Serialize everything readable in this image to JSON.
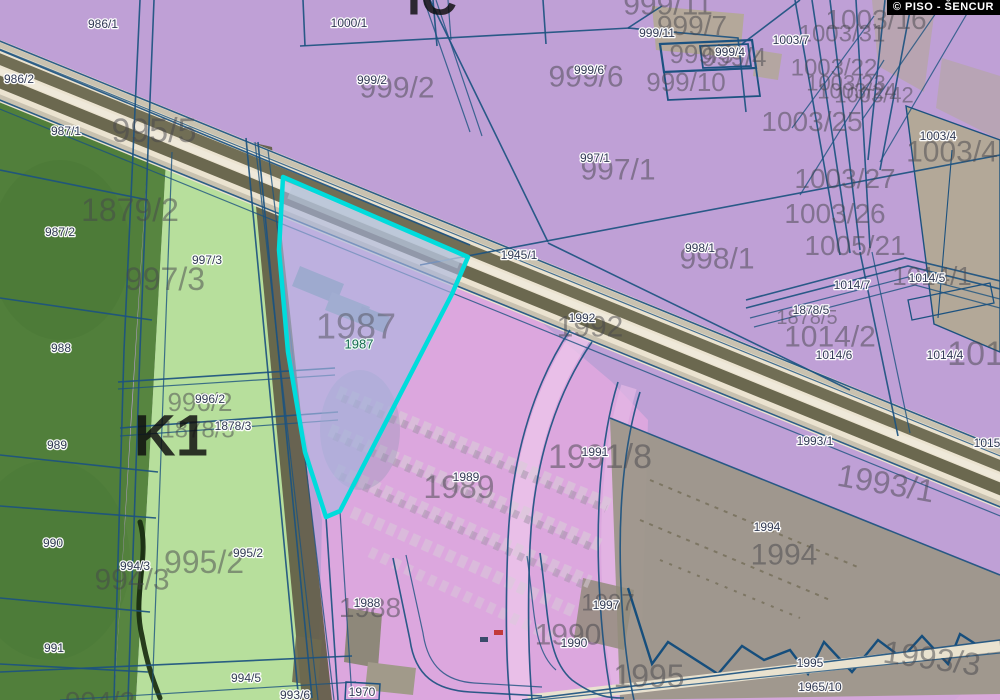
{
  "meta": {
    "copyright": "© PISO - ŠENCUR"
  },
  "colors": {
    "selected_outline": "#00dcdc",
    "selected_fill": "#a9b6e0",
    "zone_industrial_purple": "#bfa0d6",
    "zone_pink": "#e3a9e0",
    "field_dark_green": "#517f3b",
    "field_light_green": "#b7df9c",
    "boundary_line": "#1c5280",
    "road_fill": "#ebe3d0",
    "road_stripe": "#6f6c54",
    "building_gray": "#9d978a"
  },
  "selected_parcel": {
    "id": "1987"
  },
  "labels": {
    "small": [
      {
        "t": "986/1",
        "x": 103,
        "y": 24
      },
      {
        "t": "986/2",
        "x": 19,
        "y": 79
      },
      {
        "t": "987/1",
        "x": 66,
        "y": 131
      },
      {
        "t": "987/2",
        "x": 60,
        "y": 232
      },
      {
        "t": "997/3",
        "x": 207,
        "y": 260
      },
      {
        "t": "988",
        "x": 61,
        "y": 348
      },
      {
        "t": "989",
        "x": 57,
        "y": 445
      },
      {
        "t": "990",
        "x": 53,
        "y": 543
      },
      {
        "t": "991",
        "x": 54,
        "y": 648
      },
      {
        "t": "996/2",
        "x": 210,
        "y": 399
      },
      {
        "t": "1878/3",
        "x": 233,
        "y": 426
      },
      {
        "t": "994/3",
        "x": 135,
        "y": 566
      },
      {
        "t": "995/2",
        "x": 248,
        "y": 553
      },
      {
        "t": "994/5",
        "x": 246,
        "y": 678
      },
      {
        "t": "993/6",
        "x": 295,
        "y": 695
      },
      {
        "t": "1970",
        "x": 362,
        "y": 692
      },
      {
        "t": "1000/1",
        "x": 349,
        "y": 23
      },
      {
        "t": "999/2",
        "x": 372,
        "y": 80
      },
      {
        "t": "999/6",
        "x": 589,
        "y": 70
      },
      {
        "t": "999/11",
        "x": 657,
        "y": 33
      },
      {
        "t": "999/4",
        "x": 730,
        "y": 52
      },
      {
        "t": "1003/7",
        "x": 791,
        "y": 40
      },
      {
        "t": "1003/4",
        "x": 938,
        "y": 136
      },
      {
        "t": "1945/1",
        "x": 519,
        "y": 255
      },
      {
        "t": "997/1",
        "x": 595,
        "y": 158
      },
      {
        "t": "998/1",
        "x": 700,
        "y": 248
      },
      {
        "t": "1992",
        "x": 582,
        "y": 318
      },
      {
        "t": "1991",
        "x": 595,
        "y": 452
      },
      {
        "t": "1989",
        "x": 466,
        "y": 477
      },
      {
        "t": "1988",
        "x": 367,
        "y": 603
      },
      {
        "t": "1990",
        "x": 574,
        "y": 643
      },
      {
        "t": "1997",
        "x": 606,
        "y": 605
      },
      {
        "t": "1994",
        "x": 767,
        "y": 527
      },
      {
        "t": "1993/1",
        "x": 815,
        "y": 441
      },
      {
        "t": "1995",
        "x": 810,
        "y": 663
      },
      {
        "t": "1965/10",
        "x": 820,
        "y": 687
      },
      {
        "t": "1014/7",
        "x": 852,
        "y": 285
      },
      {
        "t": "1014/5",
        "x": 927,
        "y": 278
      },
      {
        "t": "1878/5",
        "x": 811,
        "y": 310
      },
      {
        "t": "1014/6",
        "x": 834,
        "y": 355
      },
      {
        "t": "1014/4",
        "x": 945,
        "y": 355
      },
      {
        "t": "1015/1",
        "x": 992,
        "y": 443
      }
    ],
    "large": [
      {
        "t": "1879/2",
        "x": 130,
        "y": 210,
        "s": 32
      },
      {
        "t": "995/5",
        "x": 154,
        "y": 130,
        "s": 34
      },
      {
        "t": "997/3",
        "x": 165,
        "y": 279,
        "s": 32
      },
      {
        "t": "996/2",
        "x": 200,
        "y": 402,
        "s": 26
      },
      {
        "t": "1878/3",
        "x": 198,
        "y": 429,
        "s": 24
      },
      {
        "t": "994/3",
        "x": 132,
        "y": 579,
        "s": 30
      },
      {
        "t": "995/2",
        "x": 204,
        "y": 562,
        "s": 32
      },
      {
        "t": "994/2",
        "x": 100,
        "y": 701,
        "s": 28
      },
      {
        "t": "999/2",
        "x": 397,
        "y": 87,
        "s": 30
      },
      {
        "t": "999/6",
        "x": 586,
        "y": 76,
        "s": 30
      },
      {
        "t": "999/11",
        "x": 668,
        "y": 4,
        "s": 30
      },
      {
        "t": "999/7",
        "x": 692,
        "y": 25,
        "s": 28
      },
      {
        "t": "999/9",
        "x": 702,
        "y": 54,
        "s": 26
      },
      {
        "t": "999/4",
        "x": 734,
        "y": 57,
        "s": 26
      },
      {
        "t": "999/10",
        "x": 686,
        "y": 82,
        "s": 26
      },
      {
        "t": "1003/16",
        "x": 876,
        "y": 19,
        "s": 28
      },
      {
        "t": "1003/31",
        "x": 842,
        "y": 33,
        "s": 24
      },
      {
        "t": "1003/22",
        "x": 834,
        "y": 67,
        "s": 24
      },
      {
        "t": "1003/23",
        "x": 846,
        "y": 83,
        "s": 22
      },
      {
        "t": "1003/24",
        "x": 857,
        "y": 91,
        "s": 22
      },
      {
        "t": "1003/42",
        "x": 874,
        "y": 95,
        "s": 22
      },
      {
        "t": "1003/25",
        "x": 812,
        "y": 121,
        "s": 28
      },
      {
        "t": "1003/27",
        "x": 845,
        "y": 178,
        "s": 28
      },
      {
        "t": "1003/26",
        "x": 835,
        "y": 213,
        "s": 28
      },
      {
        "t": "1005/21",
        "x": 855,
        "y": 245,
        "s": 28
      },
      {
        "t": "1003/4",
        "x": 952,
        "y": 151,
        "s": 30
      },
      {
        "t": "997/1",
        "x": 618,
        "y": 169,
        "s": 30
      },
      {
        "t": "998/1",
        "x": 717,
        "y": 258,
        "s": 30
      },
      {
        "t": "1992",
        "x": 590,
        "y": 326,
        "s": 30
      },
      {
        "t": "1991/8",
        "x": 600,
        "y": 456,
        "s": 34
      },
      {
        "t": "1989",
        "x": 459,
        "y": 487,
        "s": 32
      },
      {
        "t": "1988",
        "x": 370,
        "y": 607,
        "s": 28
      },
      {
        "t": "1990",
        "x": 568,
        "y": 634,
        "s": 30
      },
      {
        "t": "1997",
        "x": 608,
        "y": 602,
        "s": 24
      },
      {
        "t": "1994",
        "x": 784,
        "y": 554,
        "s": 30
      },
      {
        "t": "1993/1",
        "x": 886,
        "y": 483,
        "s": 32,
        "rot": 10
      },
      {
        "t": "1993/3",
        "x": 932,
        "y": 658,
        "s": 32,
        "rot": 8
      },
      {
        "t": "1995",
        "x": 649,
        "y": 676,
        "s": 32
      },
      {
        "t": "1014/2",
        "x": 830,
        "y": 336,
        "s": 30
      },
      {
        "t": "1014/1",
        "x": 932,
        "y": 276,
        "s": 26
      },
      {
        "t": "1878/5",
        "x": 807,
        "y": 317,
        "s": 20
      },
      {
        "t": "1014",
        "x": 985,
        "y": 353,
        "s": 34
      }
    ],
    "zone": [
      {
        "t": "IC",
        "x": 432,
        "y": -3,
        "s": 50
      },
      {
        "t": "K1",
        "x": 171,
        "y": 435,
        "s": 58
      }
    ],
    "selected": [
      {
        "t": "1987",
        "x": 356,
        "y": 326,
        "s": 36,
        "c": "lbl-sel-large"
      },
      {
        "t": "1987",
        "x": 359,
        "y": 344,
        "s": 13,
        "c": "lbl-sel-small"
      }
    ]
  }
}
